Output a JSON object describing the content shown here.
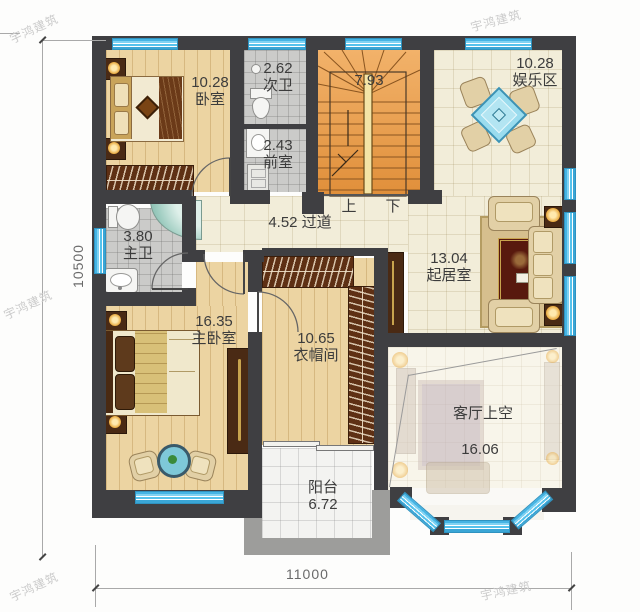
{
  "watermark": {
    "text": "宇鸿建筑"
  },
  "dimensions": {
    "bottom": "11000",
    "left": "10500"
  },
  "stairs": {
    "area": "7.93",
    "up_label": "上",
    "down_label": "下"
  },
  "rooms": {
    "bedroom": {
      "area": "10.28",
      "name": "卧室"
    },
    "secondary_bath": {
      "area": "2.62",
      "name": "次卫"
    },
    "anteroom": {
      "area": "2.43",
      "name": "前室"
    },
    "entertainment": {
      "area": "10.28",
      "name": "娱乐区"
    },
    "hallway": {
      "label": "4.52 过道"
    },
    "master_bath": {
      "area": "3.80",
      "name": "主卫"
    },
    "living": {
      "area": "13.04",
      "name": "起居室"
    },
    "master_bedroom": {
      "area": "16.35",
      "name": "主卧室"
    },
    "cloakroom": {
      "area": "10.65",
      "name": "衣帽间"
    },
    "void": {
      "name": "客厅上空",
      "area": "16.06"
    },
    "balcony": {
      "name": "阳台",
      "area": "6.72"
    }
  },
  "colors": {
    "wall": "#3f3f42",
    "window_blue": "#55c2ec",
    "wood_floor": "#ecd4a2",
    "stair_wood": "#e99f4e",
    "tile_gray": "#cbcbc9",
    "cream_floor": "#f2edd9",
    "wardrobe_brown": "#5e3014",
    "rug_red": "#58190e",
    "label_text": "#3c3c3c"
  }
}
